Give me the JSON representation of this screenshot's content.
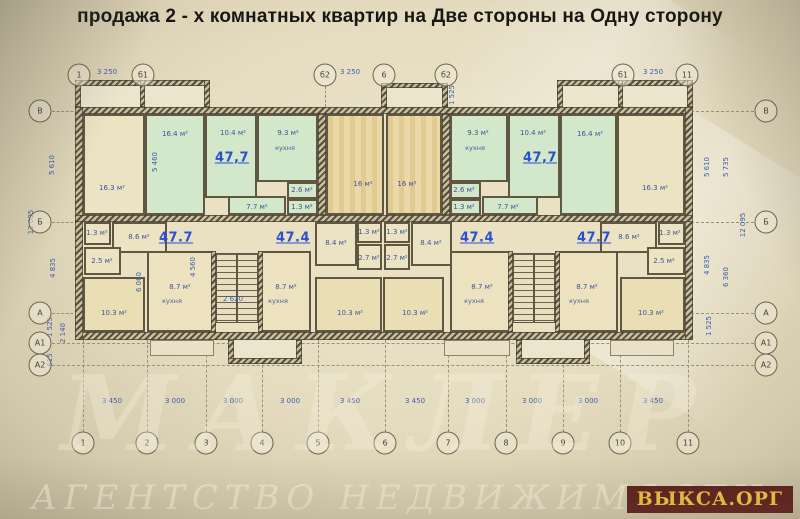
{
  "title": "продажа 2 - х комнатных квартир на Две стороны на Одну сторону",
  "watermark": {
    "badge": "ВЫКСА.ОРГ",
    "script_line": "АГЕНТСТВО НЕДВИЖИМОСТИ",
    "logo_script": "МАКЛЕР"
  },
  "colors": {
    "paper": "#e5dcc0",
    "wall_dark": "#58503e",
    "wall_hatch_light": "#c9be9e",
    "apartment_highlight_green": "#d3e8ca",
    "room_cream": "#ece3c3",
    "room_tan": "#ead8a6",
    "room_tan_light": "#eadfb4",
    "kitchen_cream": "#ece2bf",
    "dimension_blue": "#3c60ad",
    "apartment_label_blue": "#2a4ed2",
    "badge_bg": "#5a1e1a",
    "badge_text": "#eec43d"
  },
  "plan": {
    "axes": {
      "top_y": 75,
      "bottom_y": 443,
      "left_x": 40,
      "right_x": 766,
      "top": [
        {
          "label": "1",
          "x": 79
        },
        {
          "label": "б1",
          "x": 143
        },
        {
          "label": "б2",
          "x": 325
        },
        {
          "label": "6",
          "x": 384
        },
        {
          "label": "б2",
          "x": 446
        },
        {
          "label": "б1",
          "x": 623
        },
        {
          "label": "11",
          "x": 687
        }
      ],
      "bottom": [
        {
          "label": "1",
          "x": 83
        },
        {
          "label": "2",
          "x": 147
        },
        {
          "label": "3",
          "x": 206
        },
        {
          "label": "4",
          "x": 262
        },
        {
          "label": "5",
          "x": 318
        },
        {
          "label": "6",
          "x": 385
        },
        {
          "label": "7",
          "x": 448
        },
        {
          "label": "8",
          "x": 506
        },
        {
          "label": "9",
          "x": 563
        },
        {
          "label": "10",
          "x": 620
        },
        {
          "label": "11",
          "x": 688
        }
      ],
      "left": [
        {
          "label": "В",
          "y": 111
        },
        {
          "label": "Б",
          "y": 222
        },
        {
          "label": "А",
          "y": 313
        },
        {
          "label": "А1",
          "y": 343
        },
        {
          "label": "А2",
          "y": 365
        }
      ],
      "right": [
        {
          "label": "В",
          "y": 111
        },
        {
          "label": "Б",
          "y": 222
        },
        {
          "label": "А",
          "y": 313
        },
        {
          "label": "А1",
          "y": 343
        },
        {
          "label": "А2",
          "y": 365
        }
      ]
    },
    "dimensions": [
      {
        "text": "3 250",
        "x": 107,
        "y": 72
      },
      {
        "text": "3 250",
        "x": 350,
        "y": 72
      },
      {
        "text": "3 250",
        "x": 653,
        "y": 72
      },
      {
        "text": "1 525",
        "x": 452,
        "y": 95,
        "rot": true
      },
      {
        "text": "3 450",
        "x": 112,
        "y": 401
      },
      {
        "text": "3 000",
        "x": 175,
        "y": 401
      },
      {
        "text": "3 000",
        "x": 233,
        "y": 401
      },
      {
        "text": "3 000",
        "x": 290,
        "y": 401
      },
      {
        "text": "3 450",
        "x": 350,
        "y": 401
      },
      {
        "text": "3 450",
        "x": 415,
        "y": 401
      },
      {
        "text": "3 000",
        "x": 475,
        "y": 401
      },
      {
        "text": "3 000",
        "x": 532,
        "y": 401
      },
      {
        "text": "3 000",
        "x": 588,
        "y": 401
      },
      {
        "text": "3 450",
        "x": 653,
        "y": 401
      },
      {
        "text": "5 610",
        "x": 52,
        "y": 165,
        "rot": true
      },
      {
        "text": "12 095",
        "x": 31,
        "y": 222,
        "rot": true
      },
      {
        "text": "4 835",
        "x": 53,
        "y": 268,
        "rot": true
      },
      {
        "text": "1 525",
        "x": 50,
        "y": 327,
        "rot": true
      },
      {
        "text": "2 140",
        "x": 63,
        "y": 333,
        "rot": true
      },
      {
        "text": "615",
        "x": 50,
        "y": 360,
        "rot": true
      },
      {
        "text": "5 610",
        "x": 707,
        "y": 167,
        "rot": true
      },
      {
        "text": "5 735",
        "x": 726,
        "y": 167,
        "rot": true
      },
      {
        "text": "12 095",
        "x": 743,
        "y": 225,
        "rot": true
      },
      {
        "text": "4 835",
        "x": 707,
        "y": 265,
        "rot": true
      },
      {
        "text": "6 360",
        "x": 726,
        "y": 277,
        "rot": true
      },
      {
        "text": "1 525",
        "x": 709,
        "y": 326,
        "rot": true
      },
      {
        "text": "5 460",
        "x": 155,
        "y": 162,
        "rot": true
      },
      {
        "text": "4 560",
        "x": 193,
        "y": 267,
        "rot": true
      },
      {
        "text": "6 060",
        "x": 139,
        "y": 282,
        "rot": true
      },
      {
        "text": "2 620",
        "x": 233,
        "y": 299
      }
    ],
    "apartment_labels": [
      {
        "text": "47,7",
        "x": 232,
        "y": 158
      },
      {
        "text": "47,7",
        "x": 540,
        "y": 158
      },
      {
        "text": "47.7",
        "x": 176,
        "y": 238
      },
      {
        "text": "47.4",
        "x": 293,
        "y": 238
      },
      {
        "text": "47.4",
        "x": 477,
        "y": 238
      },
      {
        "text": "47.7",
        "x": 594,
        "y": 238
      }
    ],
    "rooms": [
      {
        "area": "16.3 м²",
        "fill": "c",
        "x": 83,
        "y": 114,
        "w": 62,
        "h": 101,
        "lx": 112,
        "ly": 188
      },
      {
        "area": "16.4 м²",
        "fill": "g",
        "x": 145,
        "y": 114,
        "w": 60,
        "h": 101,
        "lx": 175,
        "ly": 134
      },
      {
        "area": "10.4 м²",
        "fill": "g",
        "x": 205,
        "y": 114,
        "w": 52,
        "h": 84,
        "lx": 233,
        "ly": 133
      },
      {
        "area": "9.3 м²",
        "sub": "кухня",
        "fill": "g",
        "x": 257,
        "y": 114,
        "w": 61,
        "h": 68,
        "lx": 288,
        "ly": 133,
        "sly": 148
      },
      {
        "area": "2.6 м²",
        "fill": "g",
        "x": 287,
        "y": 182,
        "w": 31,
        "h": 17,
        "lx": 302,
        "ly": 190
      },
      {
        "area": "1.3 м²",
        "fill": "g",
        "x": 287,
        "y": 199,
        "w": 31,
        "h": 16,
        "lx": 302,
        "ly": 207
      },
      {
        "area": "7.7 м²",
        "fill": "g",
        "x": 228,
        "y": 196,
        "w": 58,
        "h": 19,
        "lx": 257,
        "ly": 207
      },
      {
        "area": "16 м²",
        "fill": "t",
        "x": 326,
        "y": 114,
        "w": 58,
        "h": 101,
        "lx": 363,
        "ly": 184
      },
      {
        "area": "16 м²",
        "fill": "t",
        "x": 386,
        "y": 114,
        "w": 56,
        "h": 101,
        "lx": 407,
        "ly": 184
      },
      {
        "area": "9.3 м²",
        "sub": "кухня",
        "fill": "g",
        "x": 450,
        "y": 114,
        "w": 58,
        "h": 68,
        "lx": 478,
        "ly": 133,
        "sly": 148
      },
      {
        "area": "10.4 м²",
        "fill": "g",
        "x": 508,
        "y": 114,
        "w": 52,
        "h": 84,
        "lx": 533,
        "ly": 133
      },
      {
        "area": "16.4 м²",
        "fill": "g",
        "x": 560,
        "y": 114,
        "w": 57,
        "h": 101,
        "lx": 590,
        "ly": 134
      },
      {
        "area": "2.6 м²",
        "fill": "g",
        "x": 450,
        "y": 182,
        "w": 31,
        "h": 17,
        "lx": 464,
        "ly": 190
      },
      {
        "area": "1.3 м²",
        "fill": "g",
        "x": 450,
        "y": 199,
        "w": 31,
        "h": 16,
        "lx": 464,
        "ly": 207
      },
      {
        "area": "7.7 м²",
        "fill": "g",
        "x": 482,
        "y": 196,
        "w": 56,
        "h": 19,
        "lx": 508,
        "ly": 207
      },
      {
        "area": "16.3 м²",
        "fill": "c",
        "x": 617,
        "y": 114,
        "w": 68,
        "h": 101,
        "lx": 655,
        "ly": 188
      },
      {
        "area": "1.3 м²",
        "fill": "c",
        "x": 84,
        "y": 222,
        "w": 27,
        "h": 23,
        "lx": 97,
        "ly": 233
      },
      {
        "area": "8.6 м²",
        "fill": "c",
        "x": 112,
        "y": 222,
        "w": 55,
        "h": 31,
        "lx": 139,
        "ly": 237
      },
      {
        "area": "2.5 м²",
        "fill": "c",
        "x": 84,
        "y": 247,
        "w": 37,
        "h": 28,
        "lx": 102,
        "ly": 261
      },
      {
        "area": "10.3 м²",
        "fill": "t2",
        "x": 83,
        "y": 277,
        "w": 62,
        "h": 55,
        "lx": 114,
        "ly": 313
      },
      {
        "area": "8.7 м²",
        "sub": "кухня",
        "fill": "k",
        "x": 147,
        "y": 251,
        "w": 68,
        "h": 81,
        "lx": 180,
        "ly": 287,
        "sly": 301
      },
      {
        "area": "8.7 м²",
        "sub": "кухня",
        "fill": "k",
        "x": 261,
        "y": 251,
        "w": 50,
        "h": 81,
        "lx": 286,
        "ly": 287,
        "sly": 301
      },
      {
        "area": "8.4 м²",
        "fill": "c",
        "x": 315,
        "y": 222,
        "w": 42,
        "h": 44,
        "lx": 336,
        "ly": 243
      },
      {
        "area": "1.3 м²",
        "fill": "c",
        "x": 357,
        "y": 222,
        "w": 25,
        "h": 21,
        "lx": 369,
        "ly": 232
      },
      {
        "area": "2.7 м²",
        "fill": "c",
        "x": 357,
        "y": 244,
        "w": 25,
        "h": 26,
        "lx": 369,
        "ly": 258
      },
      {
        "area": "1.3 м²",
        "fill": "c",
        "x": 384,
        "y": 222,
        "w": 26,
        "h": 21,
        "lx": 397,
        "ly": 232
      },
      {
        "area": "2.7 м²",
        "fill": "c",
        "x": 384,
        "y": 244,
        "w": 26,
        "h": 26,
        "lx": 397,
        "ly": 258
      },
      {
        "area": "8.4 м²",
        "fill": "c",
        "x": 411,
        "y": 222,
        "w": 41,
        "h": 44,
        "lx": 431,
        "ly": 243
      },
      {
        "area": "10.3 м²",
        "fill": "t2",
        "x": 315,
        "y": 277,
        "w": 67,
        "h": 55,
        "lx": 350,
        "ly": 313
      },
      {
        "area": "10.3 м²",
        "fill": "t2",
        "x": 383,
        "y": 277,
        "w": 61,
        "h": 55,
        "lx": 415,
        "ly": 313
      },
      {
        "area": "8.7 м²",
        "sub": "кухня",
        "fill": "k",
        "x": 450,
        "y": 251,
        "w": 62,
        "h": 81,
        "lx": 482,
        "ly": 287,
        "sly": 301
      },
      {
        "area": "8.7 м²",
        "sub": "кухня",
        "fill": "k",
        "x": 558,
        "y": 251,
        "w": 60,
        "h": 81,
        "lx": 587,
        "ly": 287,
        "sly": 301
      },
      {
        "area": "8.6 м²",
        "fill": "c",
        "x": 600,
        "y": 222,
        "w": 57,
        "h": 31,
        "lx": 629,
        "ly": 237
      },
      {
        "area": "1.3 м²",
        "fill": "c",
        "x": 658,
        "y": 222,
        "w": 27,
        "h": 23,
        "lx": 670,
        "ly": 233
      },
      {
        "area": "2.5 м²",
        "fill": "c",
        "x": 647,
        "y": 247,
        "w": 38,
        "h": 28,
        "lx": 664,
        "ly": 261
      },
      {
        "area": "10.3 м²",
        "fill": "t2",
        "x": 620,
        "y": 277,
        "w": 65,
        "h": 55,
        "lx": 651,
        "ly": 313
      }
    ],
    "walls": [
      {
        "x": 75,
        "y": 107,
        "w": 618,
        "h": 7
      },
      {
        "x": 75,
        "y": 332,
        "w": 618,
        "h": 8
      },
      {
        "x": 75,
        "y": 107,
        "w": 8,
        "h": 233
      },
      {
        "x": 685,
        "y": 107,
        "w": 8,
        "h": 233
      },
      {
        "x": 75,
        "y": 215,
        "w": 618,
        "h": 7
      },
      {
        "x": 318,
        "y": 114,
        "w": 8,
        "h": 101
      },
      {
        "x": 442,
        "y": 114,
        "w": 8,
        "h": 101
      },
      {
        "x": 75,
        "y": 80,
        "w": 6,
        "h": 27
      },
      {
        "x": 75,
        "y": 80,
        "w": 135,
        "h": 6
      },
      {
        "x": 204,
        "y": 80,
        "w": 6,
        "h": 27
      },
      {
        "x": 140,
        "y": 80,
        "w": 5,
        "h": 27
      },
      {
        "x": 381,
        "y": 83,
        "w": 6,
        "h": 24
      },
      {
        "x": 381,
        "y": 83,
        "w": 67,
        "h": 5
      },
      {
        "x": 442,
        "y": 83,
        "w": 6,
        "h": 24
      },
      {
        "x": 557,
        "y": 80,
        "w": 6,
        "h": 27
      },
      {
        "x": 557,
        "y": 80,
        "w": 136,
        "h": 6
      },
      {
        "x": 687,
        "y": 80,
        "w": 6,
        "h": 27
      },
      {
        "x": 618,
        "y": 80,
        "w": 5,
        "h": 27
      },
      {
        "x": 211,
        "y": 251,
        "w": 5,
        "h": 81
      },
      {
        "x": 258,
        "y": 251,
        "w": 5,
        "h": 81
      },
      {
        "x": 508,
        "y": 251,
        "w": 5,
        "h": 81
      },
      {
        "x": 555,
        "y": 251,
        "w": 5,
        "h": 81
      },
      {
        "x": 228,
        "y": 340,
        "w": 6,
        "h": 24
      },
      {
        "x": 296,
        "y": 340,
        "w": 6,
        "h": 24
      },
      {
        "x": 228,
        "y": 358,
        "w": 74,
        "h": 6
      },
      {
        "x": 516,
        "y": 340,
        "w": 6,
        "h": 24
      },
      {
        "x": 584,
        "y": 340,
        "w": 6,
        "h": 24
      },
      {
        "x": 516,
        "y": 358,
        "w": 74,
        "h": 6
      }
    ],
    "protrusion_interiors": [
      {
        "x": 81,
        "y": 86,
        "w": 123,
        "h": 21
      },
      {
        "x": 387,
        "y": 88,
        "w": 55,
        "h": 19
      },
      {
        "x": 563,
        "y": 86,
        "w": 124,
        "h": 21
      },
      {
        "x": 234,
        "y": 340,
        "w": 62,
        "h": 18
      },
      {
        "x": 522,
        "y": 340,
        "w": 62,
        "h": 18
      }
    ],
    "porches": [
      {
        "x": 150,
        "y": 340,
        "w": 64,
        "h": 16
      },
      {
        "x": 444,
        "y": 340,
        "w": 66,
        "h": 16
      },
      {
        "x": 610,
        "y": 340,
        "w": 64,
        "h": 16
      }
    ],
    "stairs": [
      {
        "x": 216,
        "y": 253,
        "w": 42,
        "h": 70
      },
      {
        "x": 513,
        "y": 253,
        "w": 42,
        "h": 70
      }
    ]
  }
}
